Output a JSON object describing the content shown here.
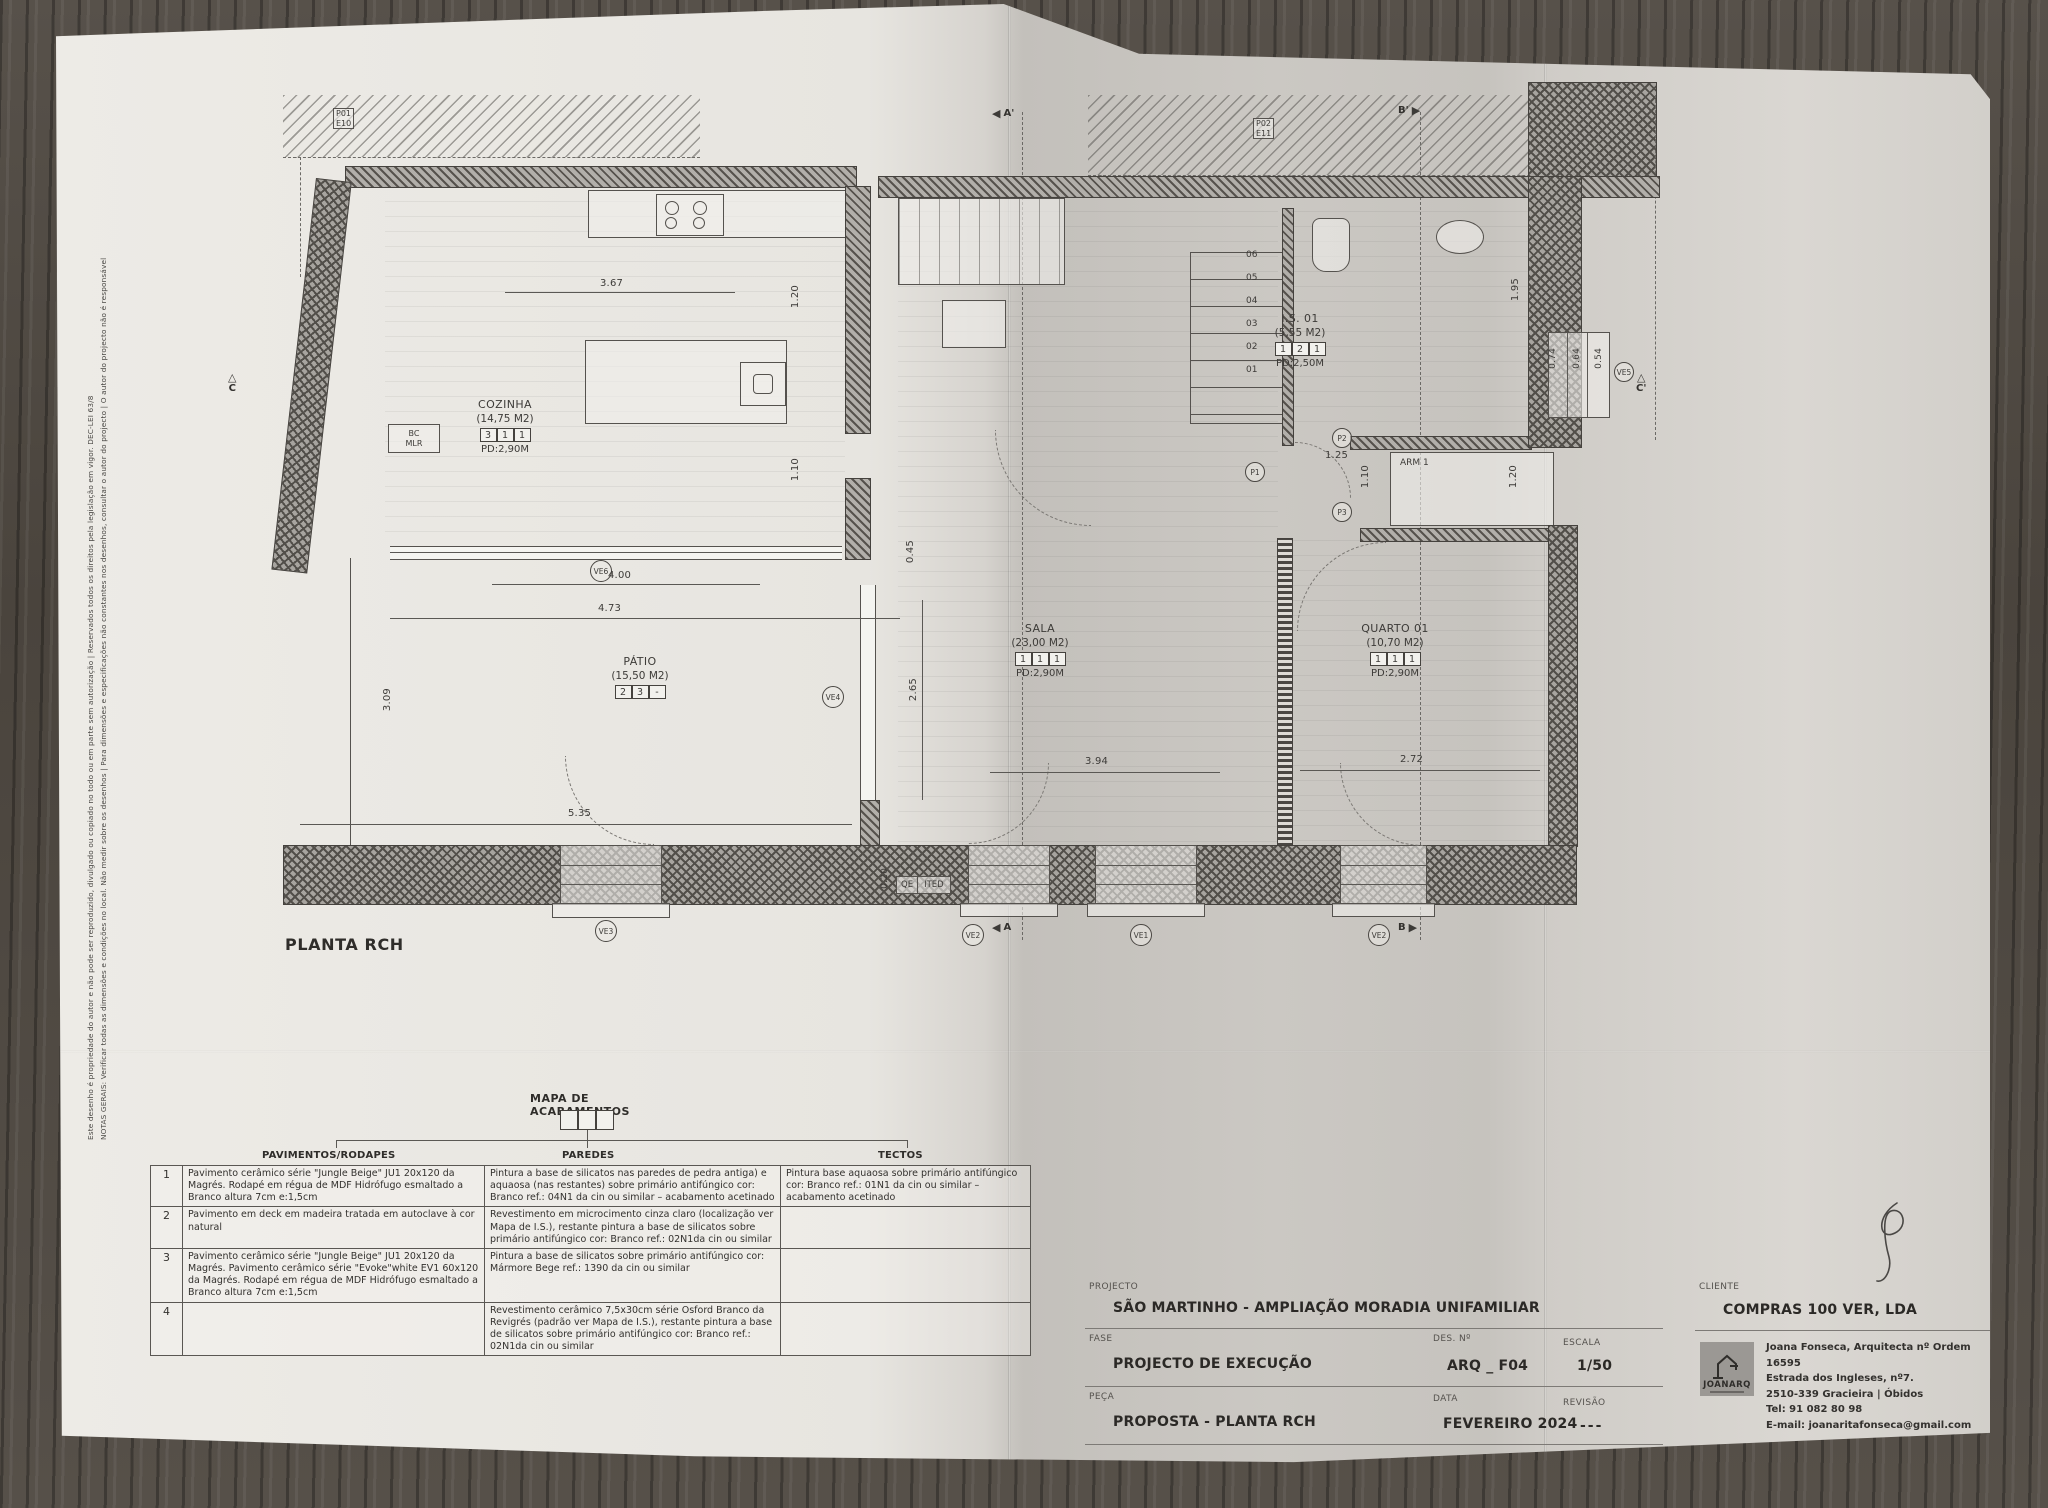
{
  "margin_notes": {
    "line1": "NOTAS GERAIS: Verificar todas as dimensões e condições no local. Não medir sobre os desenhos | Para dimensões e especificações não constantes nos desenhos, consultar o autor do projecto | O autor do projecto não é responsável por quaisquer revisões ao projecto original.",
    "line2": "Este desenho é propriedade do autor e não pode ser reproduzido, divulgado ou copiado no todo ou em parte sem autorização | Reservados todos os direitos pela legislação em vigor. DEC-LEI 63/8"
  },
  "plan": {
    "title": "PLANTA RCH",
    "rooms": {
      "cozinha": {
        "name": "COZINHA",
        "area": "(14,75 M2)",
        "codes": [
          "3",
          "1",
          "1"
        ],
        "pd": "PD:2,90M"
      },
      "patio": {
        "name": "PÁTIO",
        "area": "(15,50 M2)",
        "codes": [
          "2",
          "3",
          "-"
        ],
        "pd": ""
      },
      "sala": {
        "name": "SALA",
        "area": "(23,00 M2)",
        "codes": [
          "1",
          "1",
          "1"
        ],
        "pd": "PD:2,90M"
      },
      "is01": {
        "name": "I.S. 01",
        "area": "(5,55 M2)",
        "codes": [
          "1",
          "2",
          "1"
        ],
        "pd": "PD:2,50M"
      },
      "quarto": {
        "name": "QUARTO 01",
        "area": "(10,70 M2)",
        "codes": [
          "1",
          "1",
          "1"
        ],
        "pd": "PD:2,90M"
      },
      "arm": "ARM 1"
    },
    "boxes": {
      "qe": "QE",
      "ited": "ITED",
      "bc": "BC",
      "mlr": "MLR"
    },
    "stairs": [
      "06",
      "05",
      "04",
      "03",
      "02",
      "01"
    ],
    "dims": [
      "3.67",
      "1.20",
      "1.10",
      "4.00",
      "4.73",
      "5.35",
      "3.09",
      "2.65",
      "0.45",
      "3.94",
      "2.72",
      "1.95",
      "0.74",
      "0.64",
      "0.54",
      "1.25",
      "1.10",
      "1.20",
      "0.20"
    ],
    "markers": {
      "p01": "P01",
      "e10": "E10",
      "p02": "P02",
      "e11": "E11",
      "a_top": "A'",
      "a_bot": "A",
      "b_top": "B'",
      "b_bot": "B",
      "c_left": "C",
      "c_right": "C'",
      "p1": "P1",
      "p2": "P2",
      "p3": "P3",
      "ve1": "VE1",
      "ve2": "VE2",
      "ve3": "VE3",
      "ve4": "VE4",
      "ve5": "VE5",
      "ve6": "VE6"
    }
  },
  "finishes_table": {
    "title": "MAPA DE ACABAMENTOS",
    "columns": [
      "PAVIMENTOS/RODAPES",
      "PAREDES",
      "TECTOS"
    ],
    "rows": [
      {
        "num": "1",
        "pav": "Pavimento cerâmico série \"Jungle Beige\" JU1 20x120 da Magrés. Rodapé em régua de MDF Hidrófugo esmaltado a Branco altura 7cm e:1,5cm",
        "par": "Pintura a base de silicatos nas paredes de pedra antiga) e aquaosa (nas restantes) sobre primário antifúngico cor: Branco ref.: 04N1 da cin ou similar – acabamento acetinado",
        "tec": "Pintura base aquaosa sobre primário antifúngico cor: Branco ref.: 01N1 da cin ou similar – acabamento acetinado"
      },
      {
        "num": "2",
        "pav": "Pavimento em deck em madeira tratada em autoclave à cor natural",
        "par": "Revestimento em microcimento cinza claro (localização ver Mapa de I.S.), restante pintura a base de silicatos sobre primário antifúngico cor: Branco ref.: 02N1da cin ou similar",
        "tec": ""
      },
      {
        "num": "3",
        "pav": "Pavimento cerâmico série \"Jungle Beige\" JU1 20x120 da Magrés. Pavimento cerâmico série \"Evoke\"white EV1 60x120 da Magrés. Rodapé em régua de MDF Hidrófugo esmaltado a Branco altura 7cm e:1,5cm",
        "par": "Pintura a base de silicatos sobre primário antifúngico cor: Mármore Bege ref.: 1390 da cin ou similar",
        "tec": ""
      },
      {
        "num": "4",
        "pav": "",
        "par": "Revestimento cerâmico 7,5x30cm série Osford Branco da Revigrés (padrão ver Mapa de I.S.), restante pintura a base de silicatos sobre primário antifúngico cor: Branco ref.: 02N1da cin ou similar",
        "tec": ""
      }
    ]
  },
  "title_block": {
    "projecto_label": "PROJECTO",
    "projecto": "SÃO MARTINHO  -  AMPLIAÇÃO  MORADIA UNIFAMILIAR",
    "fase_label": "FASE",
    "fase": "PROJECTO DE EXECUÇÃO",
    "des_label": "DES. Nº",
    "des": "ARQ _ F04",
    "escala_label": "ESCALA",
    "escala": "1/50",
    "peca_label": "PEÇA",
    "peca": "PROPOSTA - PLANTA RCH",
    "data_label": "DATA",
    "data": "FEVEREIRO 2024",
    "revisao_label": "REVISÃO",
    "revisao": "---",
    "cliente_label": "CLIENTE",
    "cliente": "COMPRAS 100 VER, LDA",
    "logo_text": "JOANARQ",
    "contact": {
      "l1": "Joana Fonseca, Arquitecta nº Ordem 16595",
      "l2": "Estrada dos Ingleses, nº7.",
      "l3": "2510-339 Gracieira | Óbidos",
      "l4": "Tel: 91 082 80 98",
      "l5": "E-mail: joanaritafonseca@gmail.com"
    }
  },
  "colors": {
    "paper": "#e9e7e2",
    "paper_shade": "#c6c3be",
    "ink": "#3d3b38",
    "wood": "#4e4943",
    "wall_hatch": "#56524d"
  }
}
